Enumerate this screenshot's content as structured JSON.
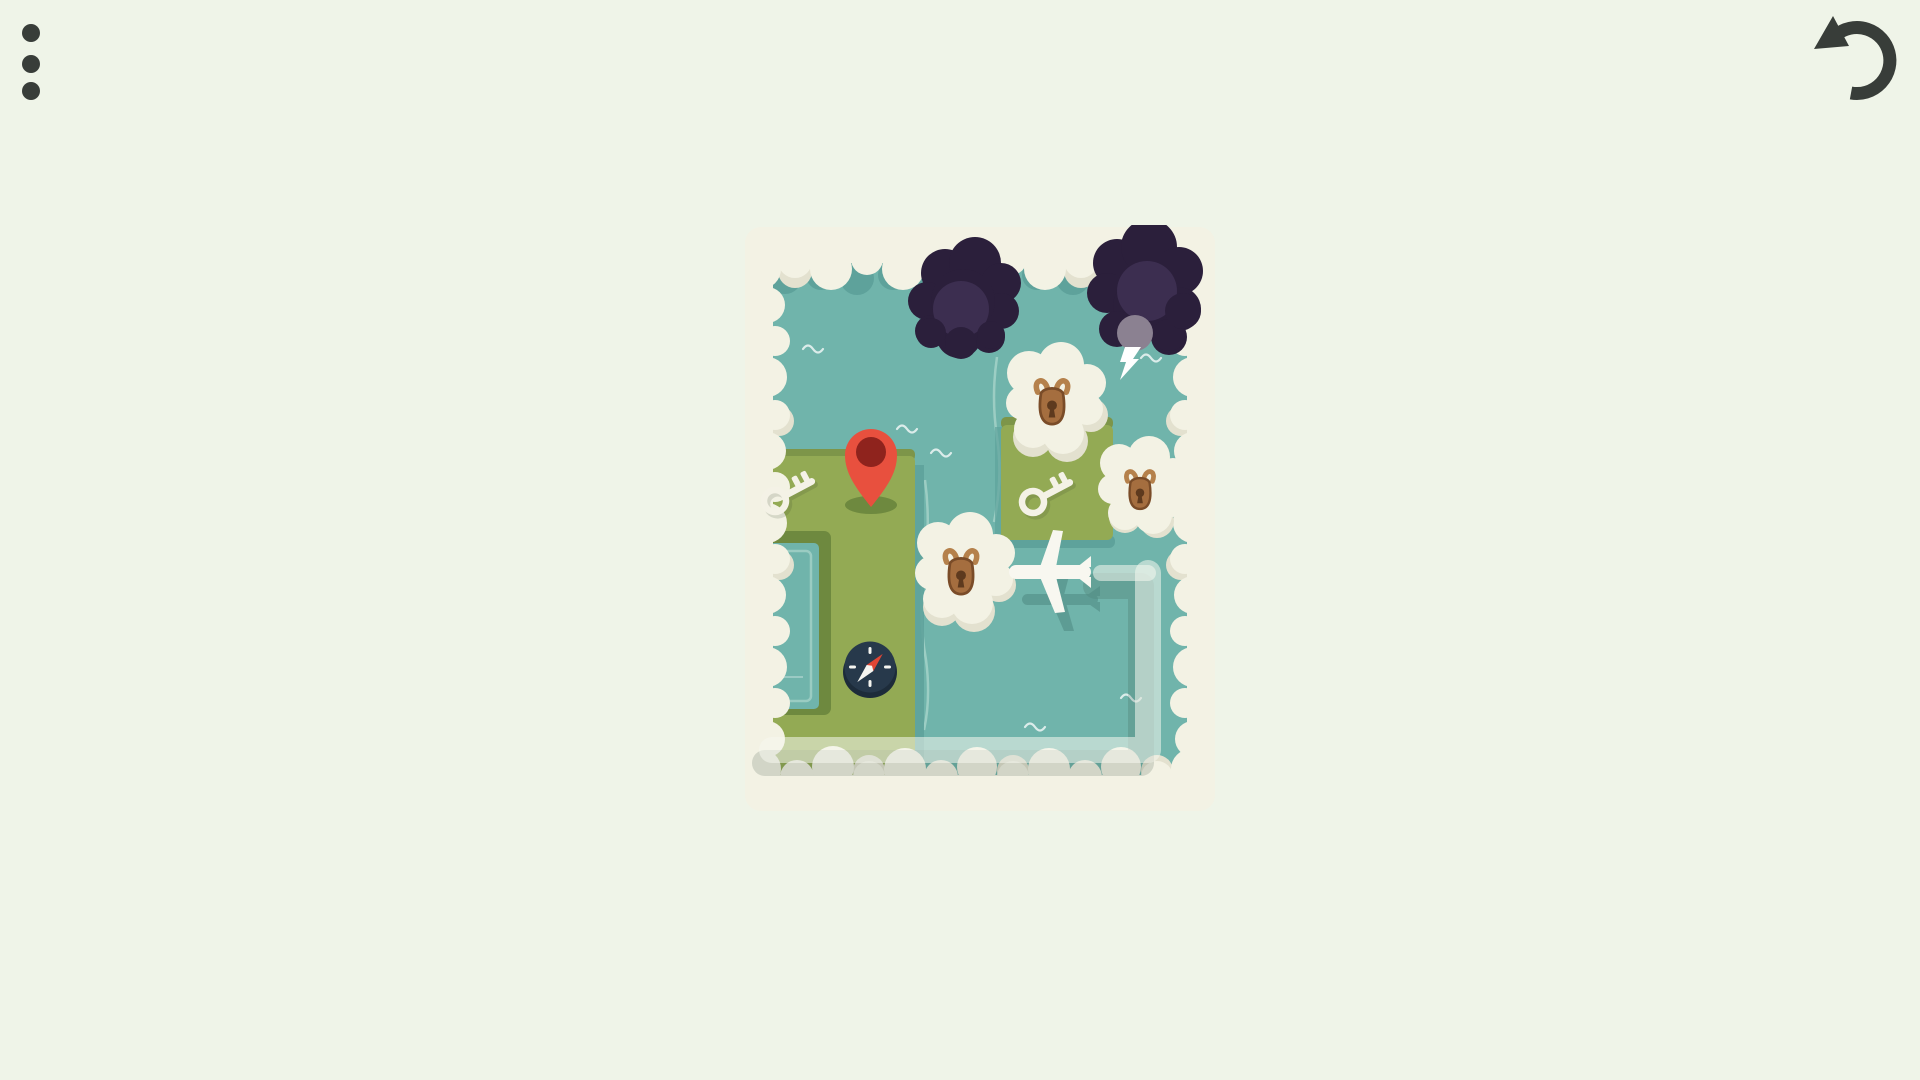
{
  "app": {
    "name": "cloud-puzzle-game",
    "background": "#eff4e8"
  },
  "toolbar": {
    "menu": {
      "icon": "kebab-menu-icon",
      "color": "#383d39",
      "dots": 3
    },
    "undo": {
      "icon": "undo-arrow-icon",
      "color": "#383d39"
    }
  },
  "palette": {
    "background": "#eff4e8",
    "icon": "#383d39",
    "water": "#70b4ab",
    "water_shade": "#5ea29b",
    "water_deep": "#4f8a82",
    "water_light": "#a8d4ca",
    "land": "#93aa54",
    "land_edge": "#7d9549",
    "land_shadow": "#6e893f",
    "cloud": "#f3f2e4",
    "cloud_shade": "#e3e1cf",
    "storm": "#2b1f3b",
    "storm_light": "#3c2e50",
    "storm_gray": "#8b8191",
    "lock_body": "#a56e3f",
    "lock_outline": "#7a4c28",
    "lock_shackle": "#b5814b",
    "lock_keyhole": "#5e3a1e",
    "key": "#f4f2e6",
    "pin": "#e8503e",
    "pin_inner": "#8f231d",
    "compass_body": "#27394b",
    "compass_rim": "#1d2c3a",
    "needle_red": "#e04534",
    "white": "#ffffff",
    "trail": "rgba(245,248,238,0.55)",
    "trail_shadow": "rgba(35,65,50,0.16)"
  },
  "map": {
    "position": {
      "left": 745,
      "top": 225,
      "width": 470,
      "height": 588
    },
    "terrain": {
      "sea": "teal water filling map",
      "lands": [
        "left-landmass-with-pin-key-compass",
        "right-green-patch-with-key",
        "bottom-left-landmass"
      ],
      "pond": "rectangular pond inset in left landmass"
    },
    "objects": {
      "storm_clouds": [
        {
          "id": 1,
          "location": "top-center",
          "has_lightning": false
        },
        {
          "id": 2,
          "location": "top-right",
          "has_lightning": true
        }
      ],
      "locked_clouds": [
        {
          "id": 1,
          "location": "upper-middle-right"
        },
        {
          "id": 2,
          "location": "mid-right-edge"
        },
        {
          "id": 3,
          "location": "center"
        }
      ],
      "keys": [
        {
          "id": 1,
          "location": "left-landmass"
        },
        {
          "id": 2,
          "location": "right-green-patch"
        }
      ],
      "pin": {
        "location": "left-landmass",
        "color": "#e8503e"
      },
      "compass": {
        "location": "lower-left-landmass",
        "needle": "red-tip-northeast"
      },
      "plane": {
        "location": "center-right-over-water",
        "heading": "west"
      },
      "trail": {
        "route": "rounded path from bottom-left eastward, then north up the right side, ending behind the plane"
      }
    },
    "counts": {
      "keys": 2,
      "locks": 3,
      "storm_clouds": 2
    }
  }
}
